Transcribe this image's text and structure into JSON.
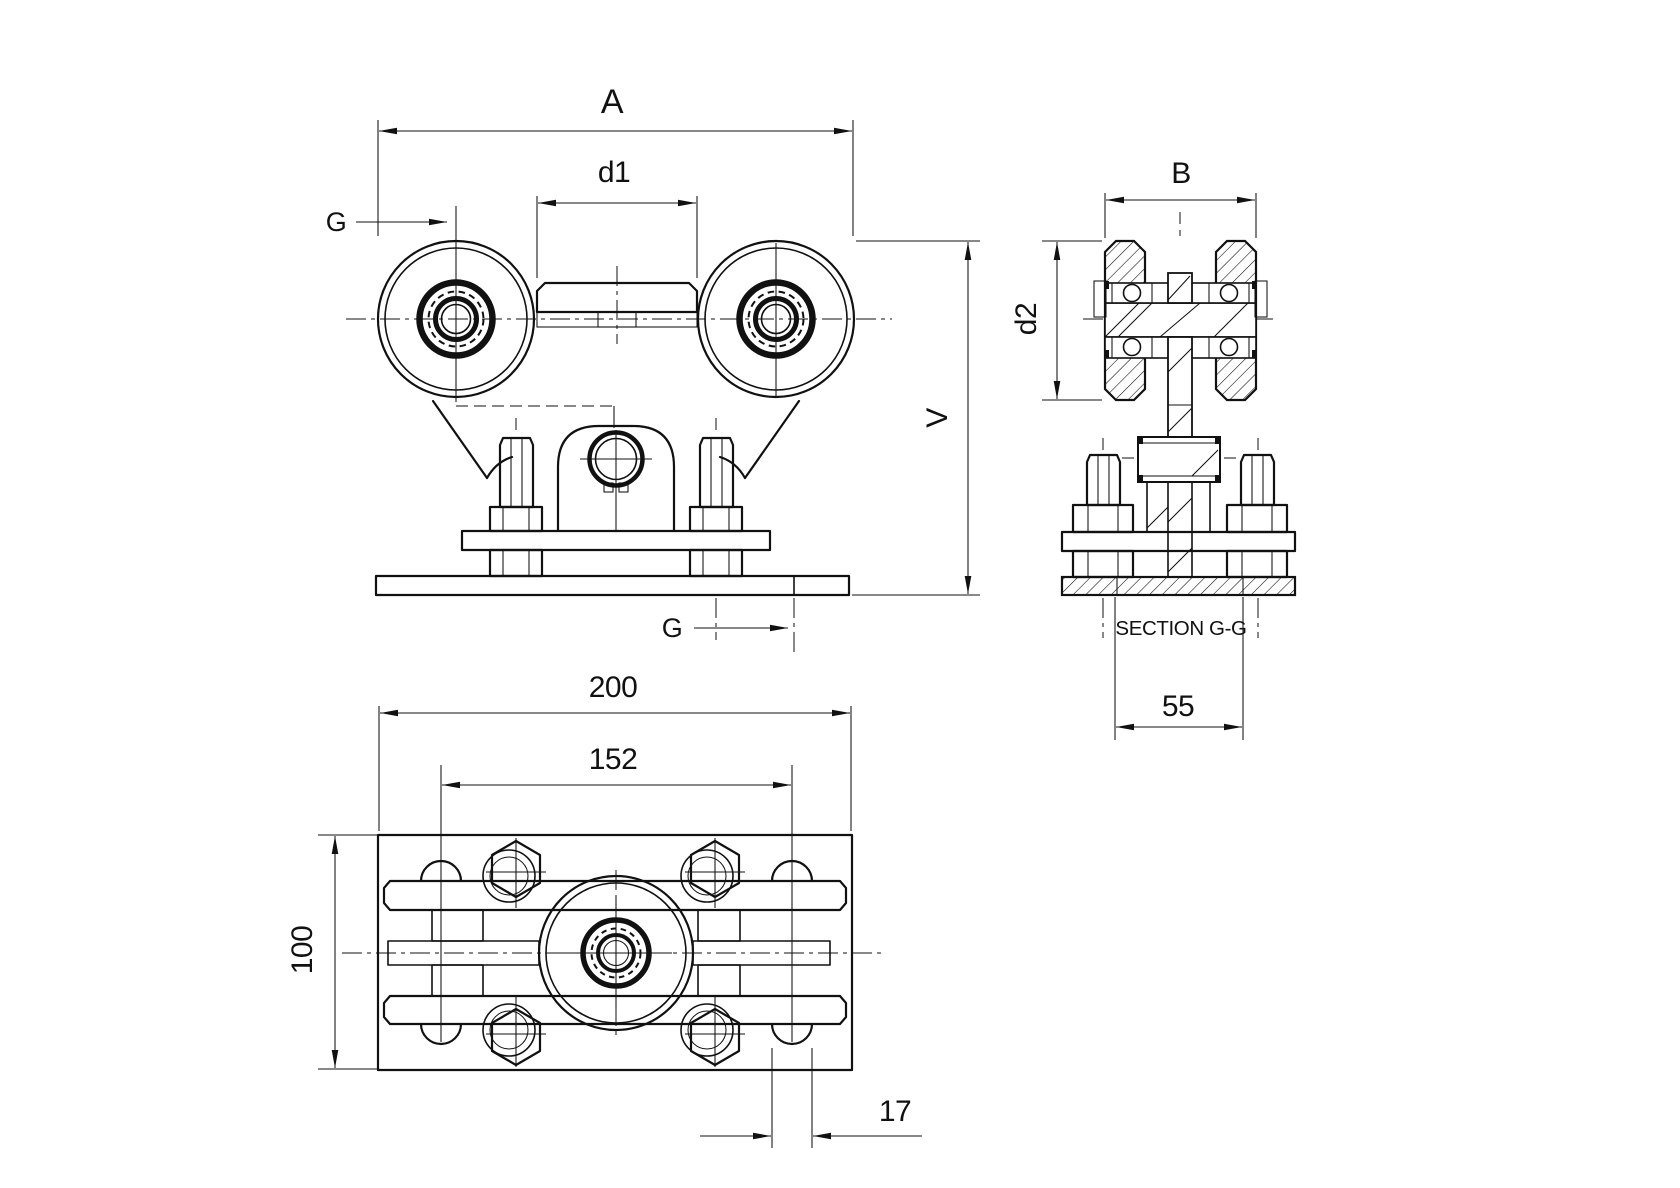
{
  "drawing": {
    "title": "roller-carriage-technical-drawing",
    "background": "#ffffff",
    "line_color": "#111111",
    "front_view": {
      "dim_A": "A",
      "dim_d1": "d1",
      "dim_V": "V",
      "section_arrow_top": "G",
      "section_arrow_bottom": "G"
    },
    "section_view": {
      "title": "SECTION G-G",
      "dim_B": "B",
      "dim_d2": "d2",
      "dim_base_width": "55"
    },
    "plan_view": {
      "dim_width": "200",
      "dim_slot_spacing": "152",
      "dim_height": "100",
      "dim_slot_width": "17"
    }
  }
}
